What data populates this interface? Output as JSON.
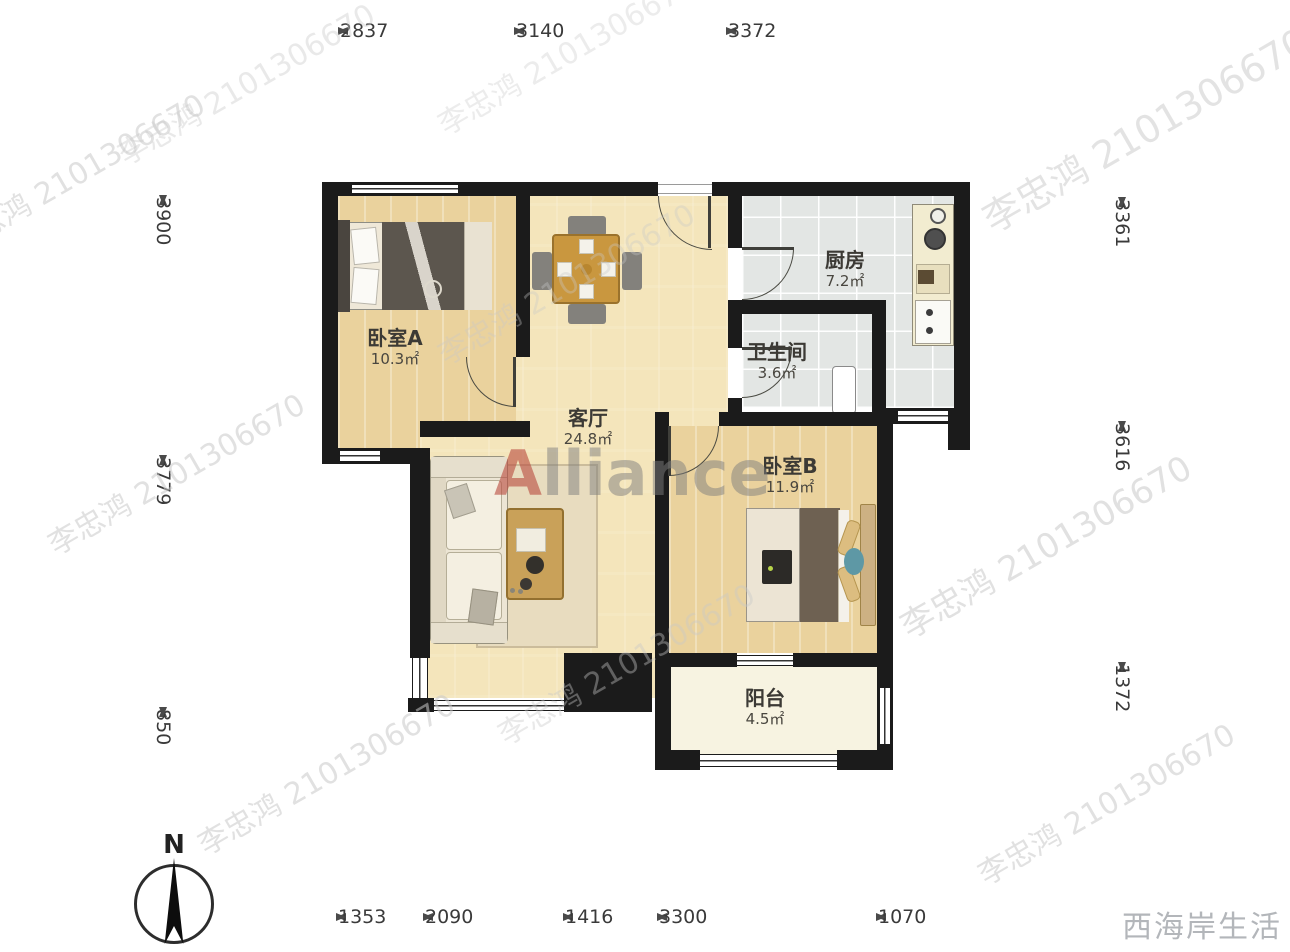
{
  "title": "两居室户型图",
  "watermark": {
    "agent_text": "李忠鸿 2101306670",
    "brand_initial": "A",
    "brand_rest": "lliance",
    "corner_text": "西海岸生活"
  },
  "compass": {
    "label": "N"
  },
  "dimensions": {
    "top": [
      "2837",
      "3140",
      "3372"
    ],
    "bottom": [
      "1353",
      "2090",
      "1416",
      "3300",
      "1070"
    ],
    "left": [
      "3900",
      "3779",
      "850"
    ],
    "right": [
      "3361",
      "3616",
      "1372"
    ]
  },
  "rooms": [
    {
      "id": "bedroom-a",
      "name": "卧室A",
      "area": "10.3㎡"
    },
    {
      "id": "living-room",
      "name": "客厅",
      "area": "24.8㎡"
    },
    {
      "id": "kitchen",
      "name": "厨房",
      "area": "7.2㎡"
    },
    {
      "id": "bathroom",
      "name": "卫生间",
      "area": "3.6㎡"
    },
    {
      "id": "bedroom-b",
      "name": "卧室B",
      "area": "11.9㎡"
    },
    {
      "id": "balcony",
      "name": "阳台",
      "area": "4.5㎡"
    }
  ],
  "colors": {
    "wall": "#1b1b1b",
    "bedroom_floor": "#ead29d",
    "living_floor": "#f4e5bb",
    "kitchen_tile": "#e3e6e4",
    "balcony_floor": "#f7f3e1",
    "watermark_gray": "#c9c9c9",
    "brand_red": "#b54d40",
    "corner_text_gray": "#b3b6ba"
  }
}
